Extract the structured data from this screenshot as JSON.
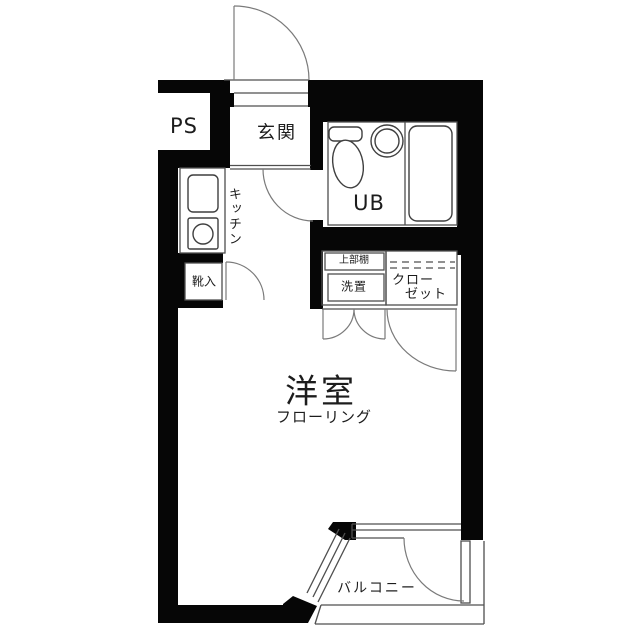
{
  "colors": {
    "wall": "#060606",
    "thin_line": "#4f4f4f",
    "door_line": "#7a7a7a",
    "fixture_line": "#3f3f3f",
    "background": "#ffffff",
    "text": "#1c1c1c"
  },
  "floorplan": {
    "rooms": {
      "ps": {
        "label": "PS"
      },
      "entrance": {
        "label": "玄関"
      },
      "unit_bath": {
        "label": "UB"
      },
      "kitchen": {
        "label": "キッチン"
      },
      "shoe_cabinet": {
        "label": "靴入"
      },
      "upper_shelf": {
        "label": "上部棚"
      },
      "washer_space": {
        "label": "洗置"
      },
      "closet": {
        "line1": "クロー",
        "line2": "ゼット"
      },
      "main_room": {
        "label": "洋室",
        "sublabel": "フローリング"
      },
      "balcony": {
        "label": "バルコニー"
      }
    },
    "fixtures": [
      "toilet",
      "wash-basin",
      "bathtub",
      "kitchen-sink",
      "stove-burner",
      "entrance-door",
      "hall-door",
      "shoe-cabinet-door",
      "washer-double-doors",
      "closet-door",
      "balcony-door",
      "diagonal-window",
      "balcony-railing",
      "closet-hanger-pipe"
    ]
  }
}
